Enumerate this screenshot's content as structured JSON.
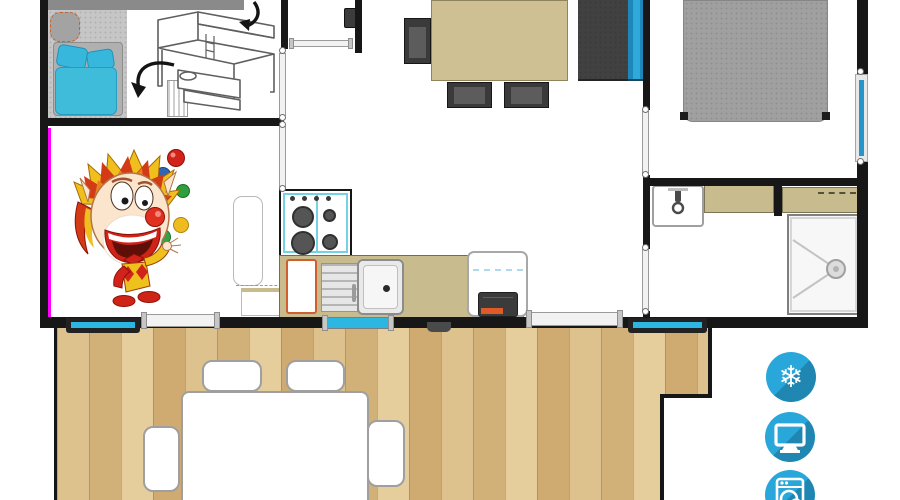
{
  "amenities": {
    "items": [
      {
        "name": "air-conditioning",
        "icon": "snowflake-icon",
        "glyph": "❄"
      },
      {
        "name": "television",
        "icon": "tv-icon"
      },
      {
        "name": "washing-machine",
        "icon": "washing-machine-icon"
      }
    ],
    "badge_color": "#2aa7da",
    "badge_shadow": "#15618c"
  },
  "colors": {
    "wall": "#171717",
    "window_accent": "#2bb7e2",
    "highlight_strip": "#ff00ff",
    "counter": "#c8bc8f",
    "dining_table": "#cec092",
    "deck_wood": "#dcbf8e",
    "bedding_blue": "#40bcdb",
    "sofa": "#414141",
    "sofa_back_blue": "#2fa9da",
    "bed_gray": "#a0a0a0",
    "cabinet_accent_orange": "#cf5f2e"
  },
  "furniture": {
    "bedroom_left": [
      "single-bed-blue-bedding",
      "bunk-bed-sketch",
      "wardrobe-strip",
      "ladder",
      "rug-seat"
    ],
    "hallway": [
      "water-heater",
      "doors"
    ],
    "living_dining": [
      "dining-table",
      "side-chair",
      "two-bottom-chairs",
      "sofa-with-blue-back",
      "juggling-clown-illustration"
    ],
    "kitchen": [
      "gas-hob-four-burners",
      "sink-with-drainboard",
      "counter",
      "orange-front-cabinet",
      "fridge",
      "dark-appliance-orange-accent",
      "open-door-leaf"
    ],
    "bedroom_right": [
      "double-bed"
    ],
    "bathroom": [
      "washbasin-with-faucet",
      "counter-left",
      "counter-right-vent",
      "shower-with-drain"
    ],
    "terrace": [
      "wood-deck",
      "outdoor-table",
      "four-outdoor-chairs"
    ],
    "openings": [
      "window-left-deck",
      "sliding-door-left",
      "window-mid",
      "sliding-door-right",
      "window-right-deck",
      "side-wall-window"
    ]
  }
}
